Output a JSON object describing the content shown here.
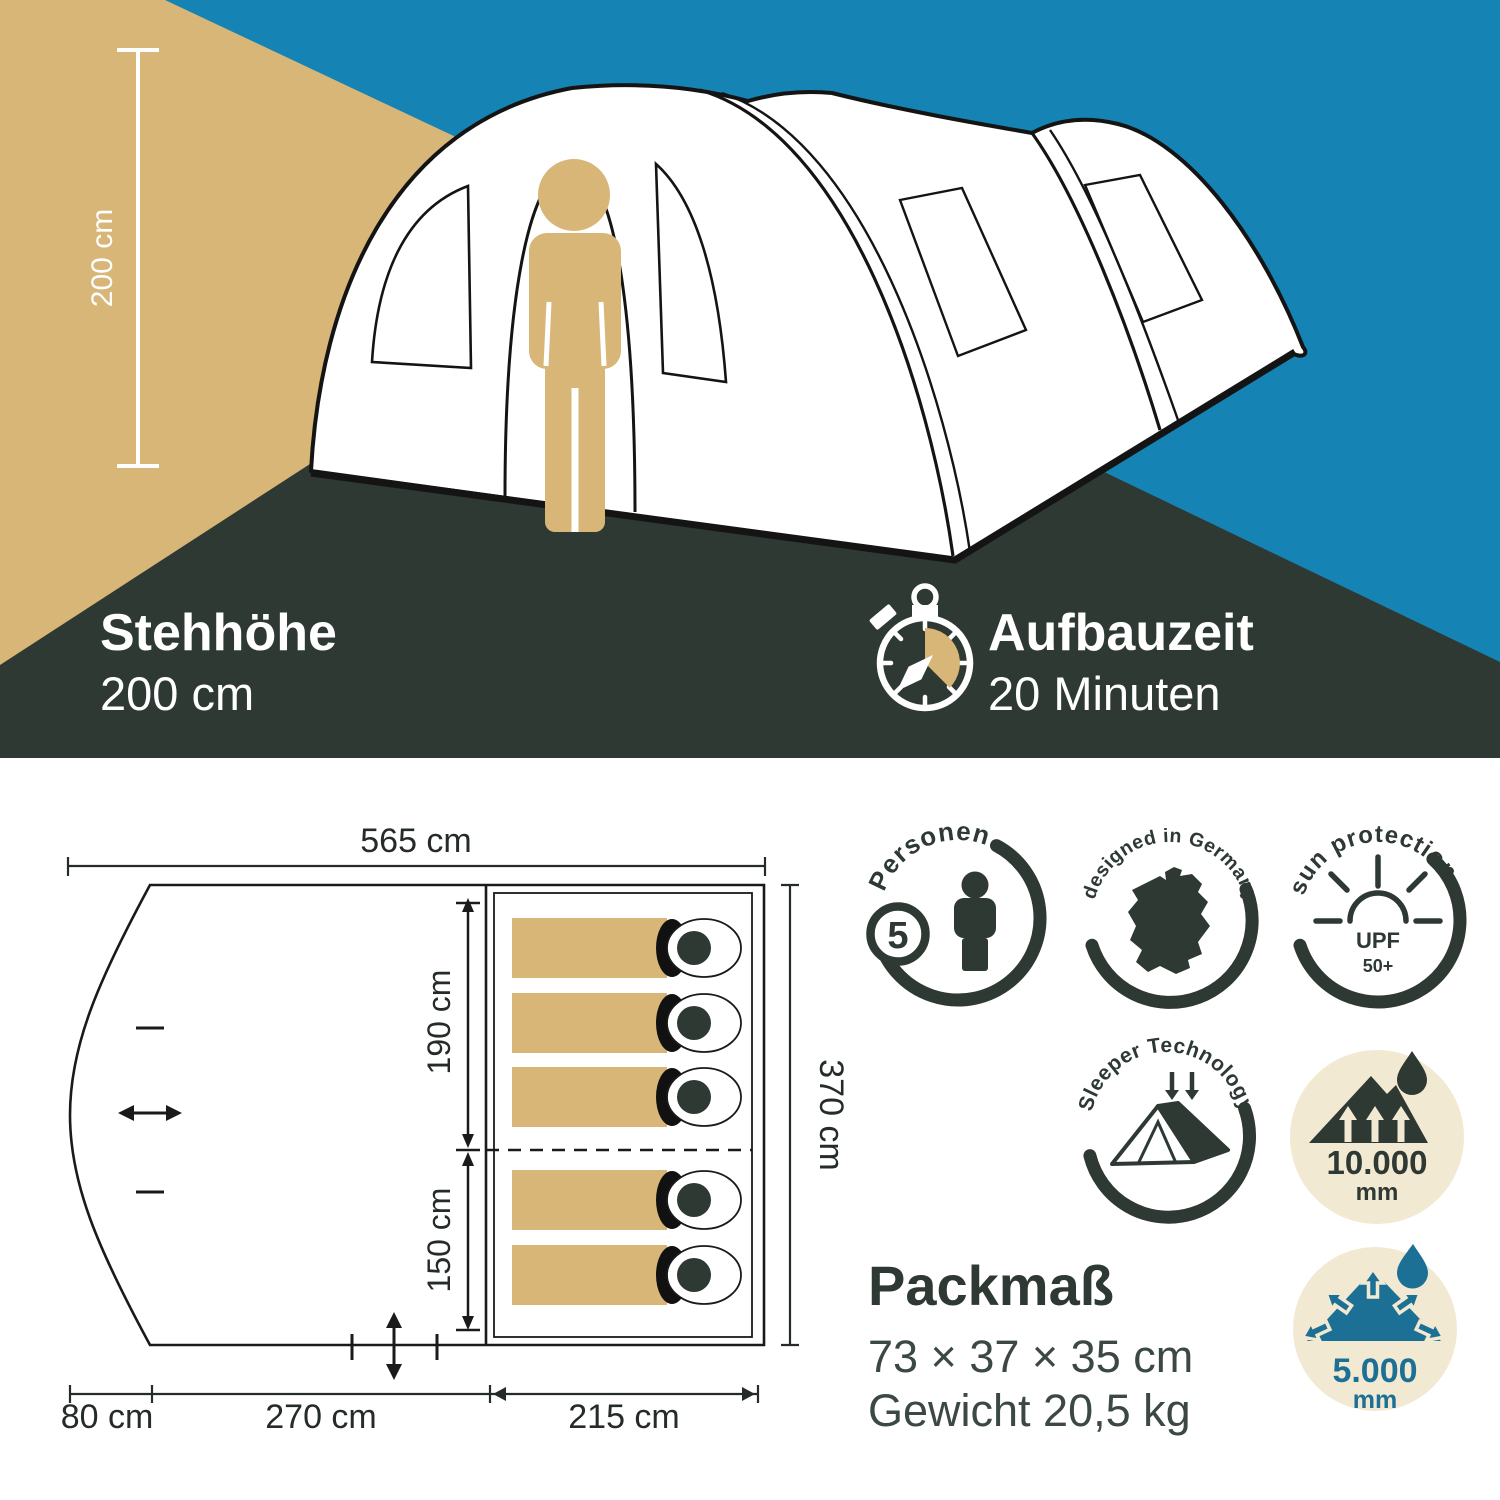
{
  "colors": {
    "banner_blue": "#1584B4",
    "wall_tan": "#D8B678",
    "floor_dark": "#2E3933",
    "badge_cream": "#F2E9D2",
    "badge_blue": "#1D7095",
    "line_black": "#1A1A1A",
    "text_dark": "#242B28",
    "text_gray": "#3C4843",
    "white": "#FFFFFF"
  },
  "banner": {
    "height_dim": "200 cm",
    "stehhoehe_title": "Stehhöhe",
    "stehhoehe_value": "200 cm",
    "aufbau_title": "Aufbauzeit",
    "aufbau_value": "20 Minuten"
  },
  "floor_plan": {
    "total_width": "565 cm",
    "total_depth": "370 cm",
    "cabin_length": "190 cm",
    "cabin2_length": "150 cm",
    "vestibule_width": "80 cm",
    "living_width": "270 cm",
    "sleeping_width": "215 cm",
    "sleeping_bag_count": 5
  },
  "badges": {
    "persons": {
      "count": "5",
      "label": "Personen"
    },
    "germany": {
      "label": "designed in Germany"
    },
    "sun": {
      "label": "sun protection",
      "line1": "UPF",
      "line2": "50+"
    },
    "sleeper": {
      "label": "Sleeper Technology"
    },
    "water_outer": {
      "value": "10.000",
      "unit": "mm"
    },
    "water_floor": {
      "value": "5.000",
      "unit": "mm"
    }
  },
  "pack": {
    "title": "Packmaß",
    "size": "73 × 37 × 35 cm",
    "weight": "Gewicht 20,5 kg"
  }
}
